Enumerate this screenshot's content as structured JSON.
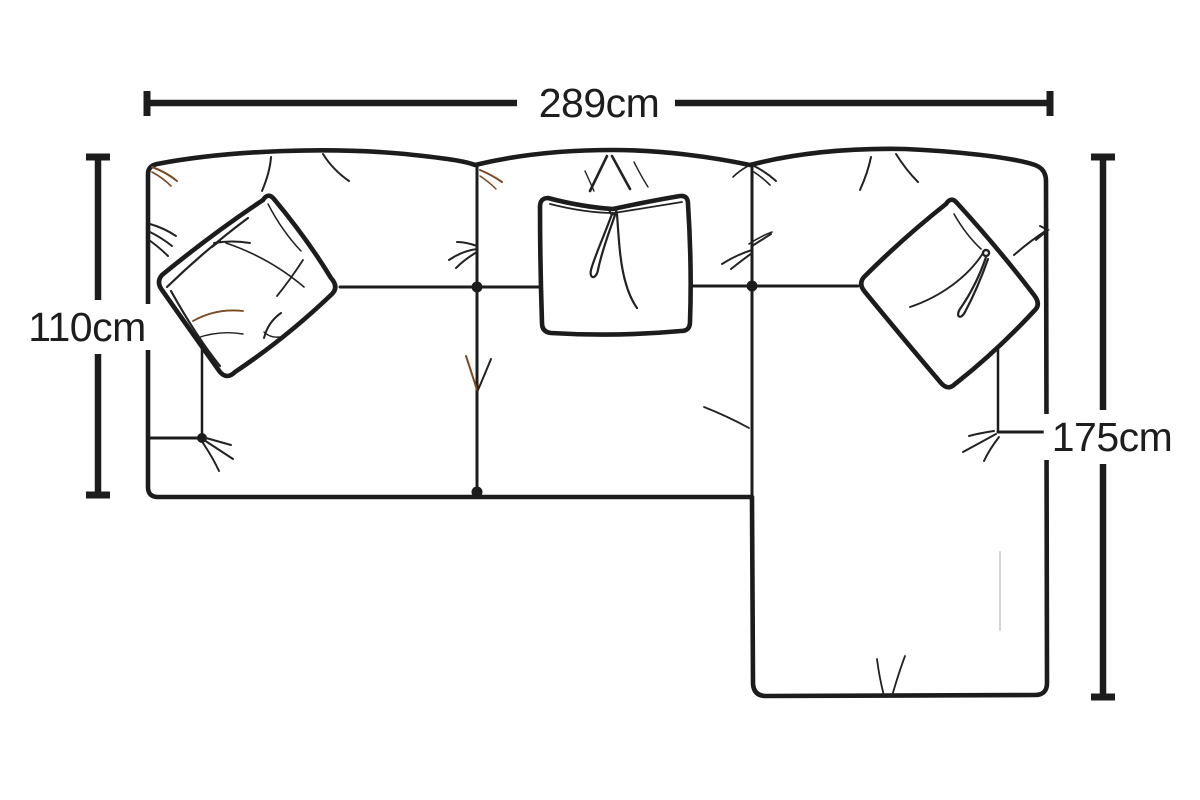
{
  "diagram": {
    "type": "sofa-top-view-dimension-diagram",
    "dimensions": {
      "width": {
        "label": "289cm",
        "value": 289,
        "unit": "cm"
      },
      "depth": {
        "label": "110cm",
        "value": 110,
        "unit": "cm"
      },
      "chaise": {
        "label": "175cm",
        "value": 175,
        "unit": "cm"
      }
    },
    "colors": {
      "ink": "#1c1c1c",
      "crease_brown": "#7a4a22",
      "faint_gray": "#d4d4d4",
      "background": "#ffffff"
    }
  }
}
